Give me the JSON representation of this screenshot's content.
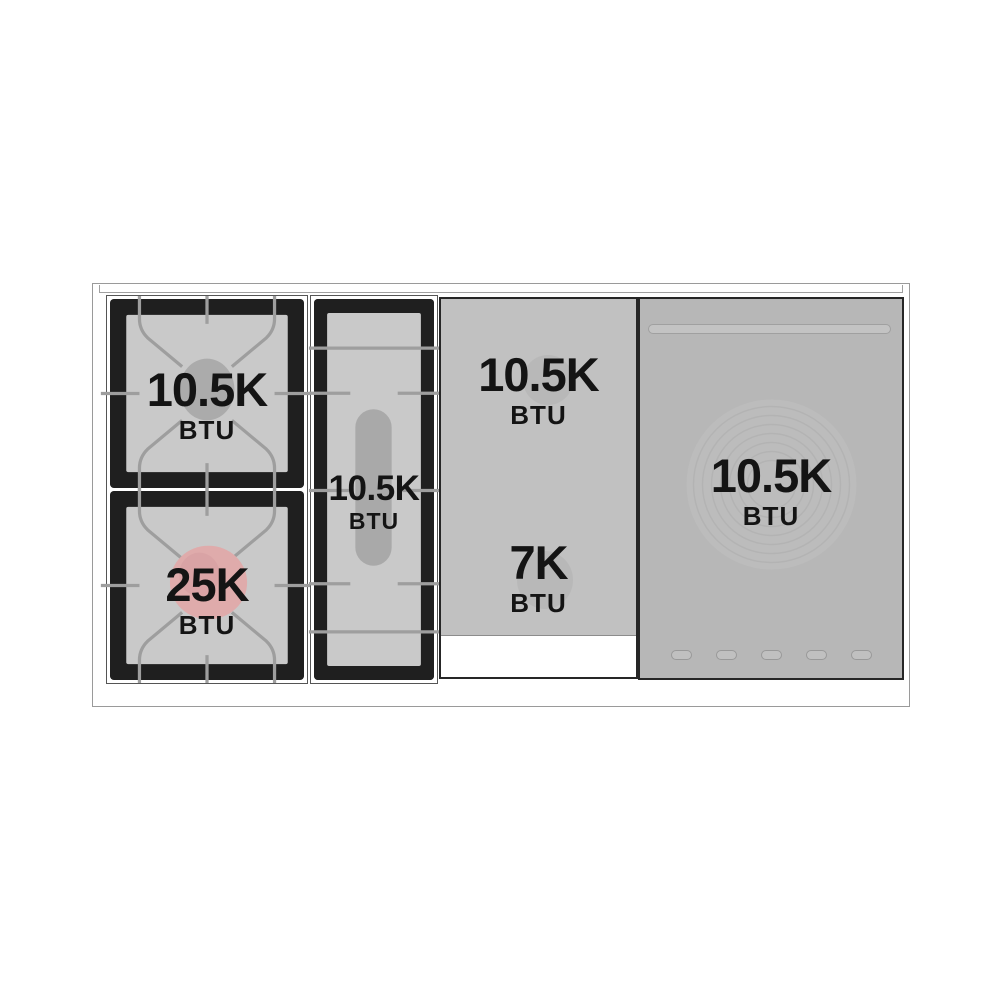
{
  "diagram": {
    "title": "Range top burner layout diagram",
    "colors": {
      "frame_line": "#9a9a9a",
      "section_black": "#1f1f1f",
      "grate_surface": "#c9c9c9",
      "grate_line": "#9e9e9e",
      "griddle_panel": "#c1c1c1",
      "right_panel": "#b7b7b7",
      "burner_cap_gray": "#ababab",
      "oval_burner_gray": "#a9a9a9",
      "burner_cap_pink": "#dfabab",
      "burner_cap_pink_inner": "#d49ca0",
      "ring_circle": "#bcbcbc",
      "text": "#141414"
    },
    "burners": [
      {
        "id": "left-rear-burner",
        "value": "10.5K",
        "unit": "BTU"
      },
      {
        "id": "left-front-burner",
        "value": "25K",
        "unit": "BTU"
      },
      {
        "id": "center-oval-burner",
        "value": "10.5K",
        "unit": "BTU"
      },
      {
        "id": "griddle-rear-burner",
        "value": "10.5K",
        "unit": "BTU"
      },
      {
        "id": "griddle-front-burner",
        "value": "7K",
        "unit": "BTU"
      },
      {
        "id": "right-round-burner",
        "value": "10.5K",
        "unit": "BTU"
      }
    ]
  }
}
